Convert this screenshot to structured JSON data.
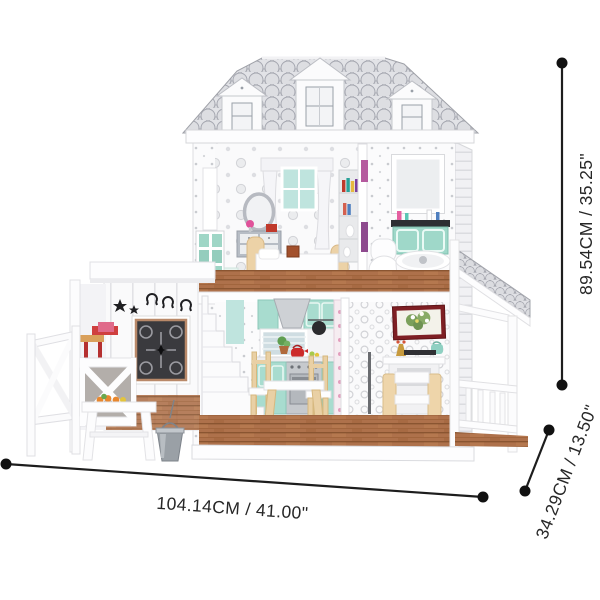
{
  "scene": {
    "description": "Product dimension photo of a two-storey white farmhouse dollhouse with grey scalloped barn roof, three dormers, side stable with white fence and bucket, furnished bedroom, bathroom, kitchen, dining and living rooms, and a right-hand shingled porch",
    "dimension_labels": {
      "width": "104.14CM / 41.00\"",
      "height": "89.54CM / 35.25\"",
      "depth": "34.29CM / 13.50\""
    },
    "colors": {
      "background": "#ffffff",
      "annotation_line": "#1d1d1d",
      "roof_shingle_grey": "#dcdde1",
      "house_white": "#fbfbfc",
      "accent_teal": "#a8dccf",
      "window_teal": "#bfe4de",
      "wood_floor_brown": "#ae714b",
      "furniture_wood_tan": "#ecd2a7",
      "picture_frame_maroon": "#7e1f24",
      "kettle_red": "#cc2b2b",
      "bucket_grey": "#9aa0a6",
      "grille_dark": "#3a3a3e"
    }
  }
}
